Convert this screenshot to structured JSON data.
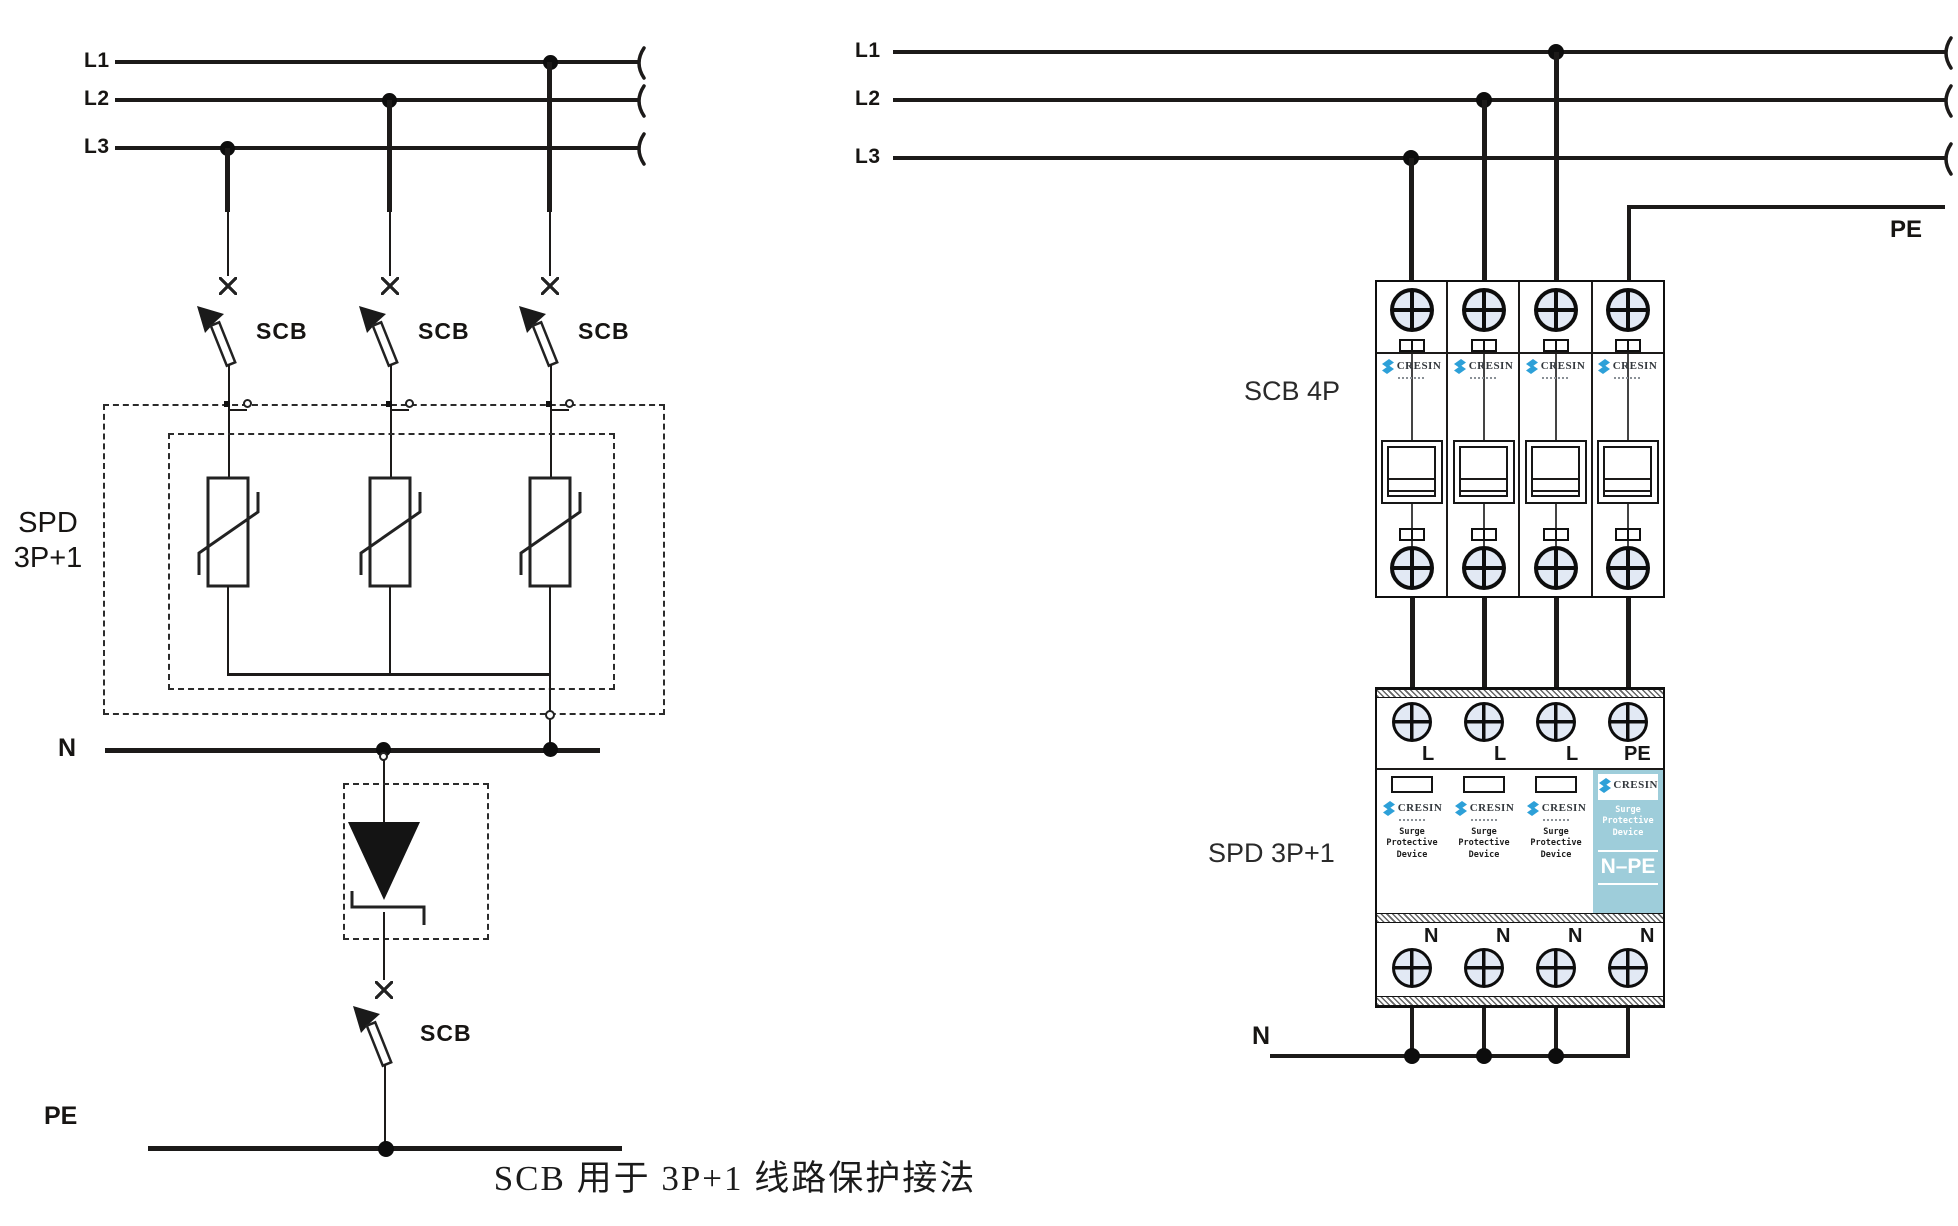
{
  "caption": "SCB 用于 3P+1 线路保护接法",
  "colors": {
    "wire": "#1c1a19",
    "terminal_fill": "#e2e9f4",
    "npe_module_bg": "#9ecdda",
    "brand_blue": "#2da0d8"
  },
  "left": {
    "phase_labels": [
      "L1",
      "L2",
      "L3"
    ],
    "scb_labels": [
      "SCB",
      "SCB",
      "SCB"
    ],
    "spd_label": [
      "SPD",
      "3P+1"
    ],
    "neutral_label": "N",
    "npe_scb_label": "SCB",
    "pe_label": "PE"
  },
  "right": {
    "phase_labels": [
      "L1",
      "L2",
      "L3"
    ],
    "pe_label": "PE",
    "scb_block_label": "SCB 4P",
    "spd_block_label": "SPD 3P+1",
    "brand": "CRESIN",
    "spd_terminal_labels": [
      "L",
      "L",
      "L",
      "PE"
    ],
    "device_text": [
      "Surge Protective",
      "Device"
    ],
    "npe_label": "N–PE",
    "bottom_terminal_labels": [
      "N",
      "N",
      "N",
      "N"
    ],
    "neutral_label": "N"
  }
}
